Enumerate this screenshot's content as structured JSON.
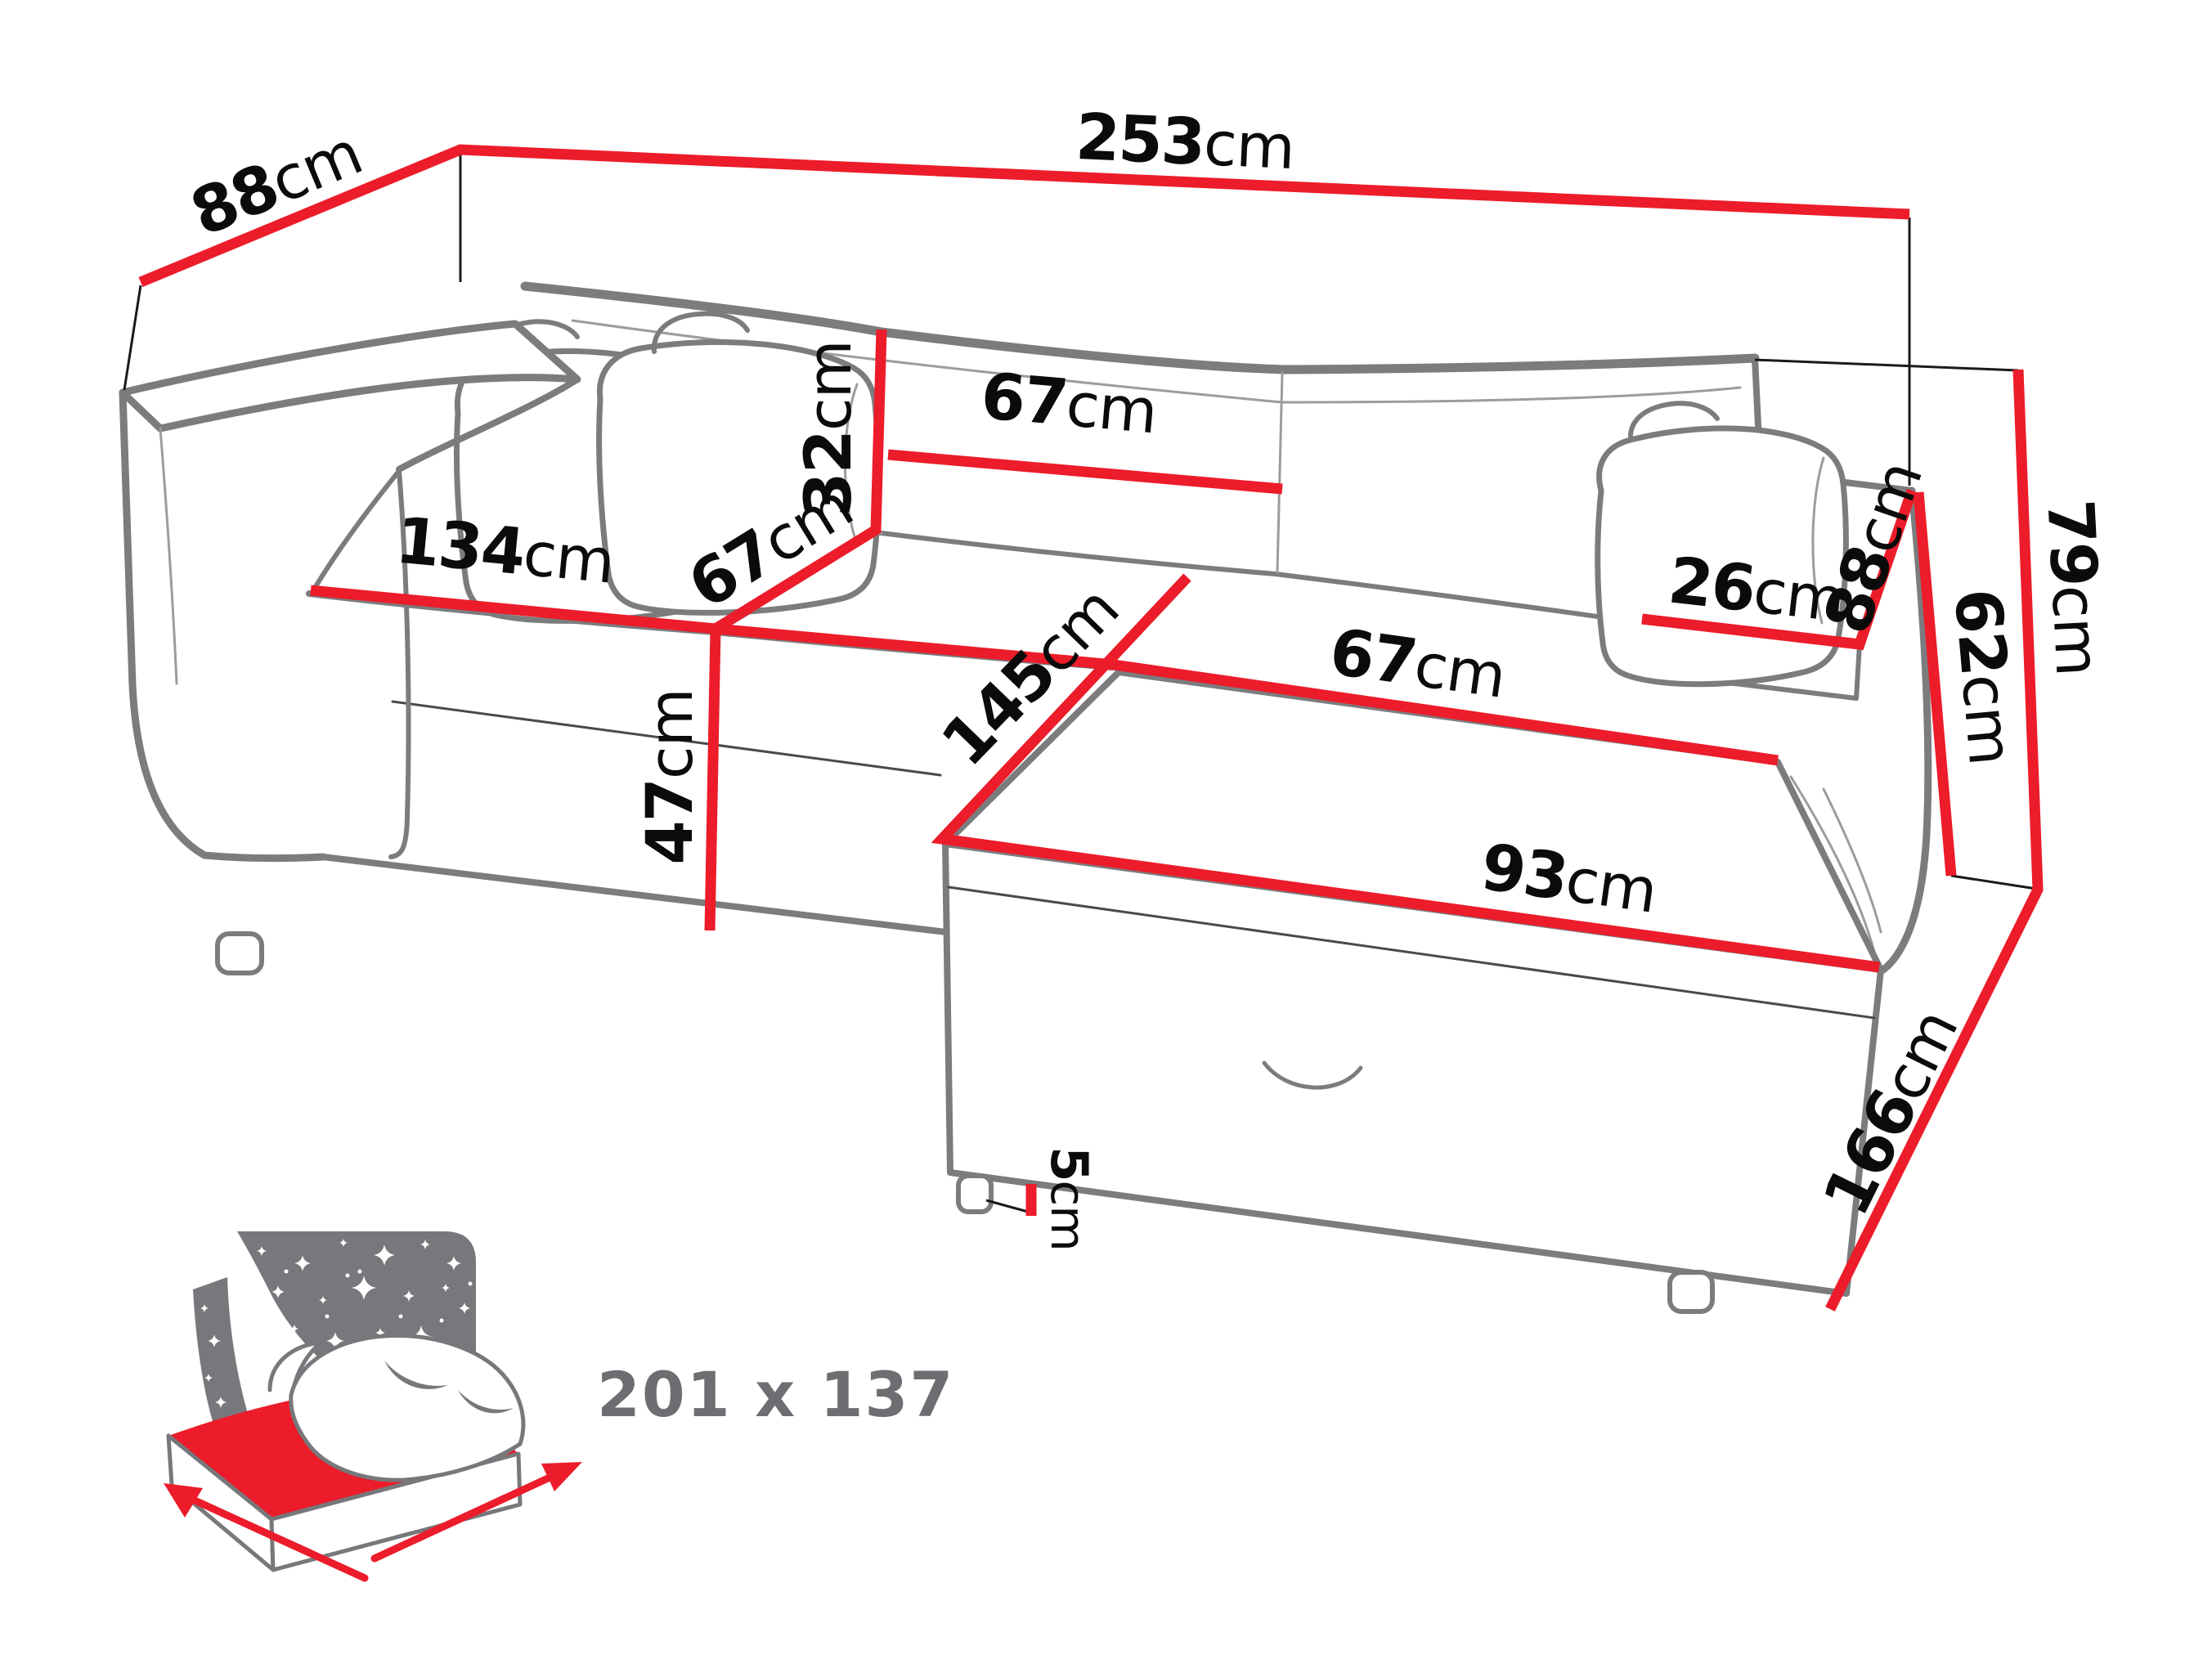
{
  "diagram": {
    "type": "corner-sofa-bed-dimension-diagram",
    "unit": "cm"
  },
  "colors": {
    "dimension_line": "#EC1C2A",
    "sketch_outline": "#7B7C7E",
    "label_text": "#0B0B0B",
    "icon_gray": "#77787B",
    "icon_text_gray": "#6D6E71"
  },
  "dimensions": {
    "total_width": {
      "value": "253",
      "unit": "cm"
    },
    "depth_back_left": {
      "value": "88",
      "unit": "cm"
    },
    "backrest_cushion_width": {
      "value": "67",
      "unit": "cm"
    },
    "backrest_cushion_height": {
      "value": "32",
      "unit": "cm"
    },
    "seat_front_width": {
      "value": "134",
      "unit": "cm"
    },
    "seat_depth": {
      "value": "67",
      "unit": "cm"
    },
    "seat_height": {
      "value": "47",
      "unit": "cm"
    },
    "armrest_width": {
      "value": "26",
      "unit": "cm"
    },
    "armrest_depth": {
      "value": "88",
      "unit": "cm"
    },
    "side_height": {
      "value": "62",
      "unit": "cm"
    },
    "total_height": {
      "value": "79",
      "unit": "cm"
    },
    "chaise_width": {
      "value": "67",
      "unit": "cm"
    },
    "chaise_length": {
      "value": "145",
      "unit": "cm"
    },
    "chaise_front_width": {
      "value": "93",
      "unit": "cm"
    },
    "leg_height": {
      "value": "5",
      "unit": "cm"
    },
    "side_length": {
      "value": "166",
      "unit": "cm"
    }
  },
  "sleeping_area": {
    "label": "201 x 137"
  }
}
